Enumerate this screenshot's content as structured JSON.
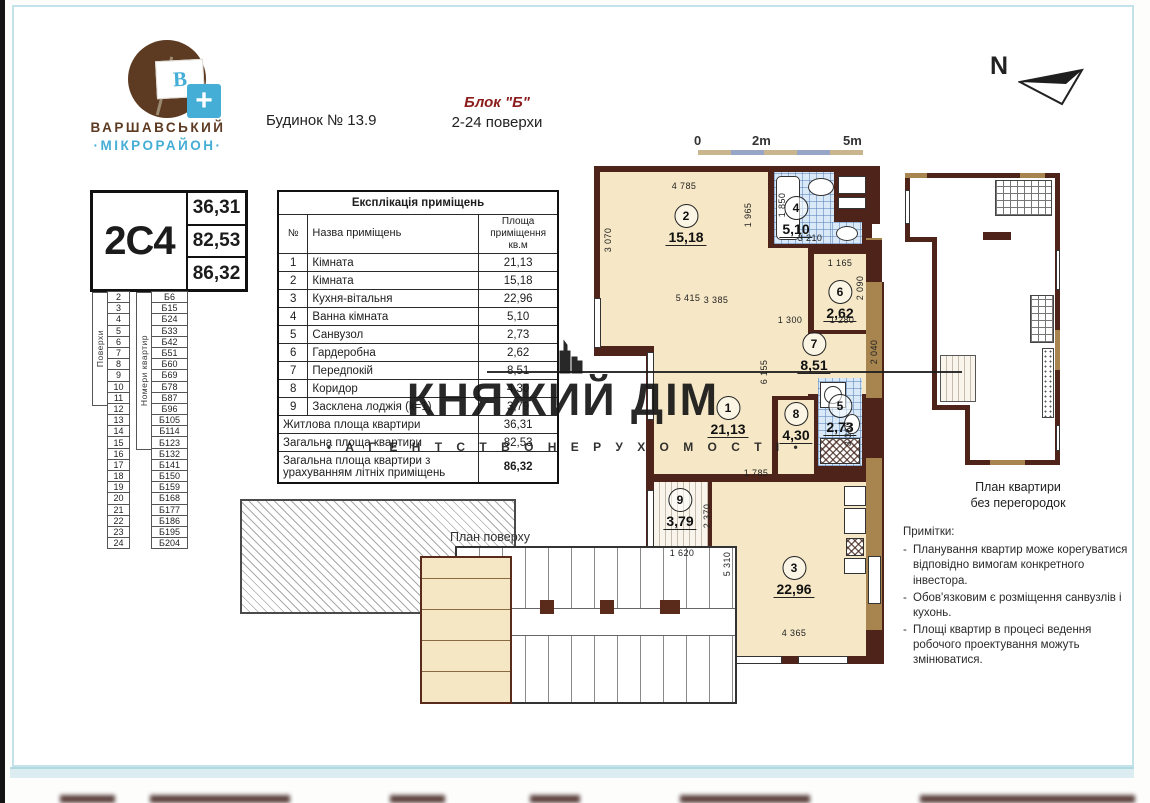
{
  "logo": {
    "title_line1": "ВАРШАВСЬКИЙ",
    "title_line2": "·МІКРОРАЙОН·",
    "flag_letter": "В",
    "plus": "+"
  },
  "header": {
    "building": "Будинок № 13.9",
    "block": "Блок \"Б\"",
    "floors_range": "2-24 поверхи"
  },
  "north_label": "N",
  "scale_bar": {
    "zero": "0",
    "mid": "2m",
    "end": "5m",
    "segment_colors": [
      "#c9b68f",
      "#97a6c6",
      "#c9b68f",
      "#97a6c6",
      "#c9b68f"
    ]
  },
  "unit_card": {
    "code": "2С4",
    "living_area": "36,31",
    "total_area": "82,53",
    "full_area": "86,32"
  },
  "floors_table": {
    "floors_header": "Поверхи",
    "apartments_header": "Номери квартир",
    "floors": [
      "2",
      "3",
      "4",
      "5",
      "6",
      "7",
      "8",
      "9",
      "10",
      "11",
      "12",
      "13",
      "14",
      "15",
      "16",
      "17",
      "18",
      "19",
      "20",
      "21",
      "22",
      "23",
      "24"
    ],
    "apartments": [
      "Б6",
      "Б15",
      "Б24",
      "Б33",
      "Б42",
      "Б51",
      "Б60",
      "Б69",
      "Б78",
      "Б87",
      "Б96",
      "Б105",
      "Б114",
      "Б123",
      "Б132",
      "Б141",
      "Б150",
      "Б159",
      "Б168",
      "Б177",
      "Б186",
      "Б195",
      "Б204"
    ]
  },
  "explication": {
    "title": "Експлікація приміщень",
    "col_num": "№",
    "col_name": "Назва приміщень",
    "col_area": "Площа приміщення кв.м",
    "rows": [
      [
        "1",
        "Кімната",
        "21,13"
      ],
      [
        "2",
        "Кімната",
        "15,18"
      ],
      [
        "3",
        "Кухня-вітальня",
        "22,96"
      ],
      [
        "4",
        "Ванна кімната",
        "5,10"
      ],
      [
        "5",
        "Санвузол",
        "2,73"
      ],
      [
        "6",
        "Гардеробна",
        "2,62"
      ],
      [
        "7",
        "Передпокій",
        "8,51"
      ],
      [
        "8",
        "Коридор",
        "4,30"
      ],
      [
        "9",
        "Засклена лоджія (k=1)",
        "3,79"
      ]
    ],
    "summary": [
      {
        "label": "Житлова площа квартири",
        "value": "36,31"
      },
      {
        "label": "Загальна площа квартири",
        "value": "82,53"
      },
      {
        "label": "Загальна площа квартири з урахуванням літніх приміщень",
        "value": "86,32"
      }
    ]
  },
  "plan": {
    "rooms": {
      "r1": {
        "num": "1",
        "area": "21,13"
      },
      "r2": {
        "num": "2",
        "area": "15,18"
      },
      "r3": {
        "num": "3",
        "area": "22,96"
      },
      "r4": {
        "num": "4",
        "area": "5,10"
      },
      "r5": {
        "num": "5",
        "area": "2,73"
      },
      "r6": {
        "num": "6",
        "area": "2,62"
      },
      "r7": {
        "num": "7",
        "area": "8,51"
      },
      "r8": {
        "num": "8",
        "area": "4,30"
      },
      "r9": {
        "num": "9",
        "area": "3,79"
      }
    },
    "dims": {
      "d4785": "4 785",
      "d3070": "3 070",
      "d1965": "1 965",
      "d5415": "5 415",
      "d1850": "1 850",
      "d3210": "3 210",
      "d1165": "1 165",
      "d2090": "2 090",
      "d1300": "1 300",
      "d1280": "1 280",
      "d2040": "2 040",
      "d6155": "6 155",
      "d3385": "3 385",
      "d3360": "3 360",
      "d1785": "1 785",
      "d2370": "2 370",
      "d1620": "1 620",
      "d5310": "5 310",
      "d4365": "4 365"
    }
  },
  "floor_plan_label": "План поверху",
  "right_plan_caption_1": "План квартири",
  "right_plan_caption_2": "без перегородок",
  "notes": {
    "title": "Примітки:",
    "items": [
      "Планування квартир може корегуватися відповідно вимогам конкретного інвестора.",
      "Обов'язковим є розміщення санвузлів і кухонь.",
      "Площі квартир в процесі ведення робочого проектування можуть змінюватися."
    ]
  },
  "watermark": {
    "title": "КНЯЖИЙ ДІМ",
    "subtitle": "• А Г Е Н Т С Т В О   Н Е Р У Х О М О С Т І •"
  }
}
